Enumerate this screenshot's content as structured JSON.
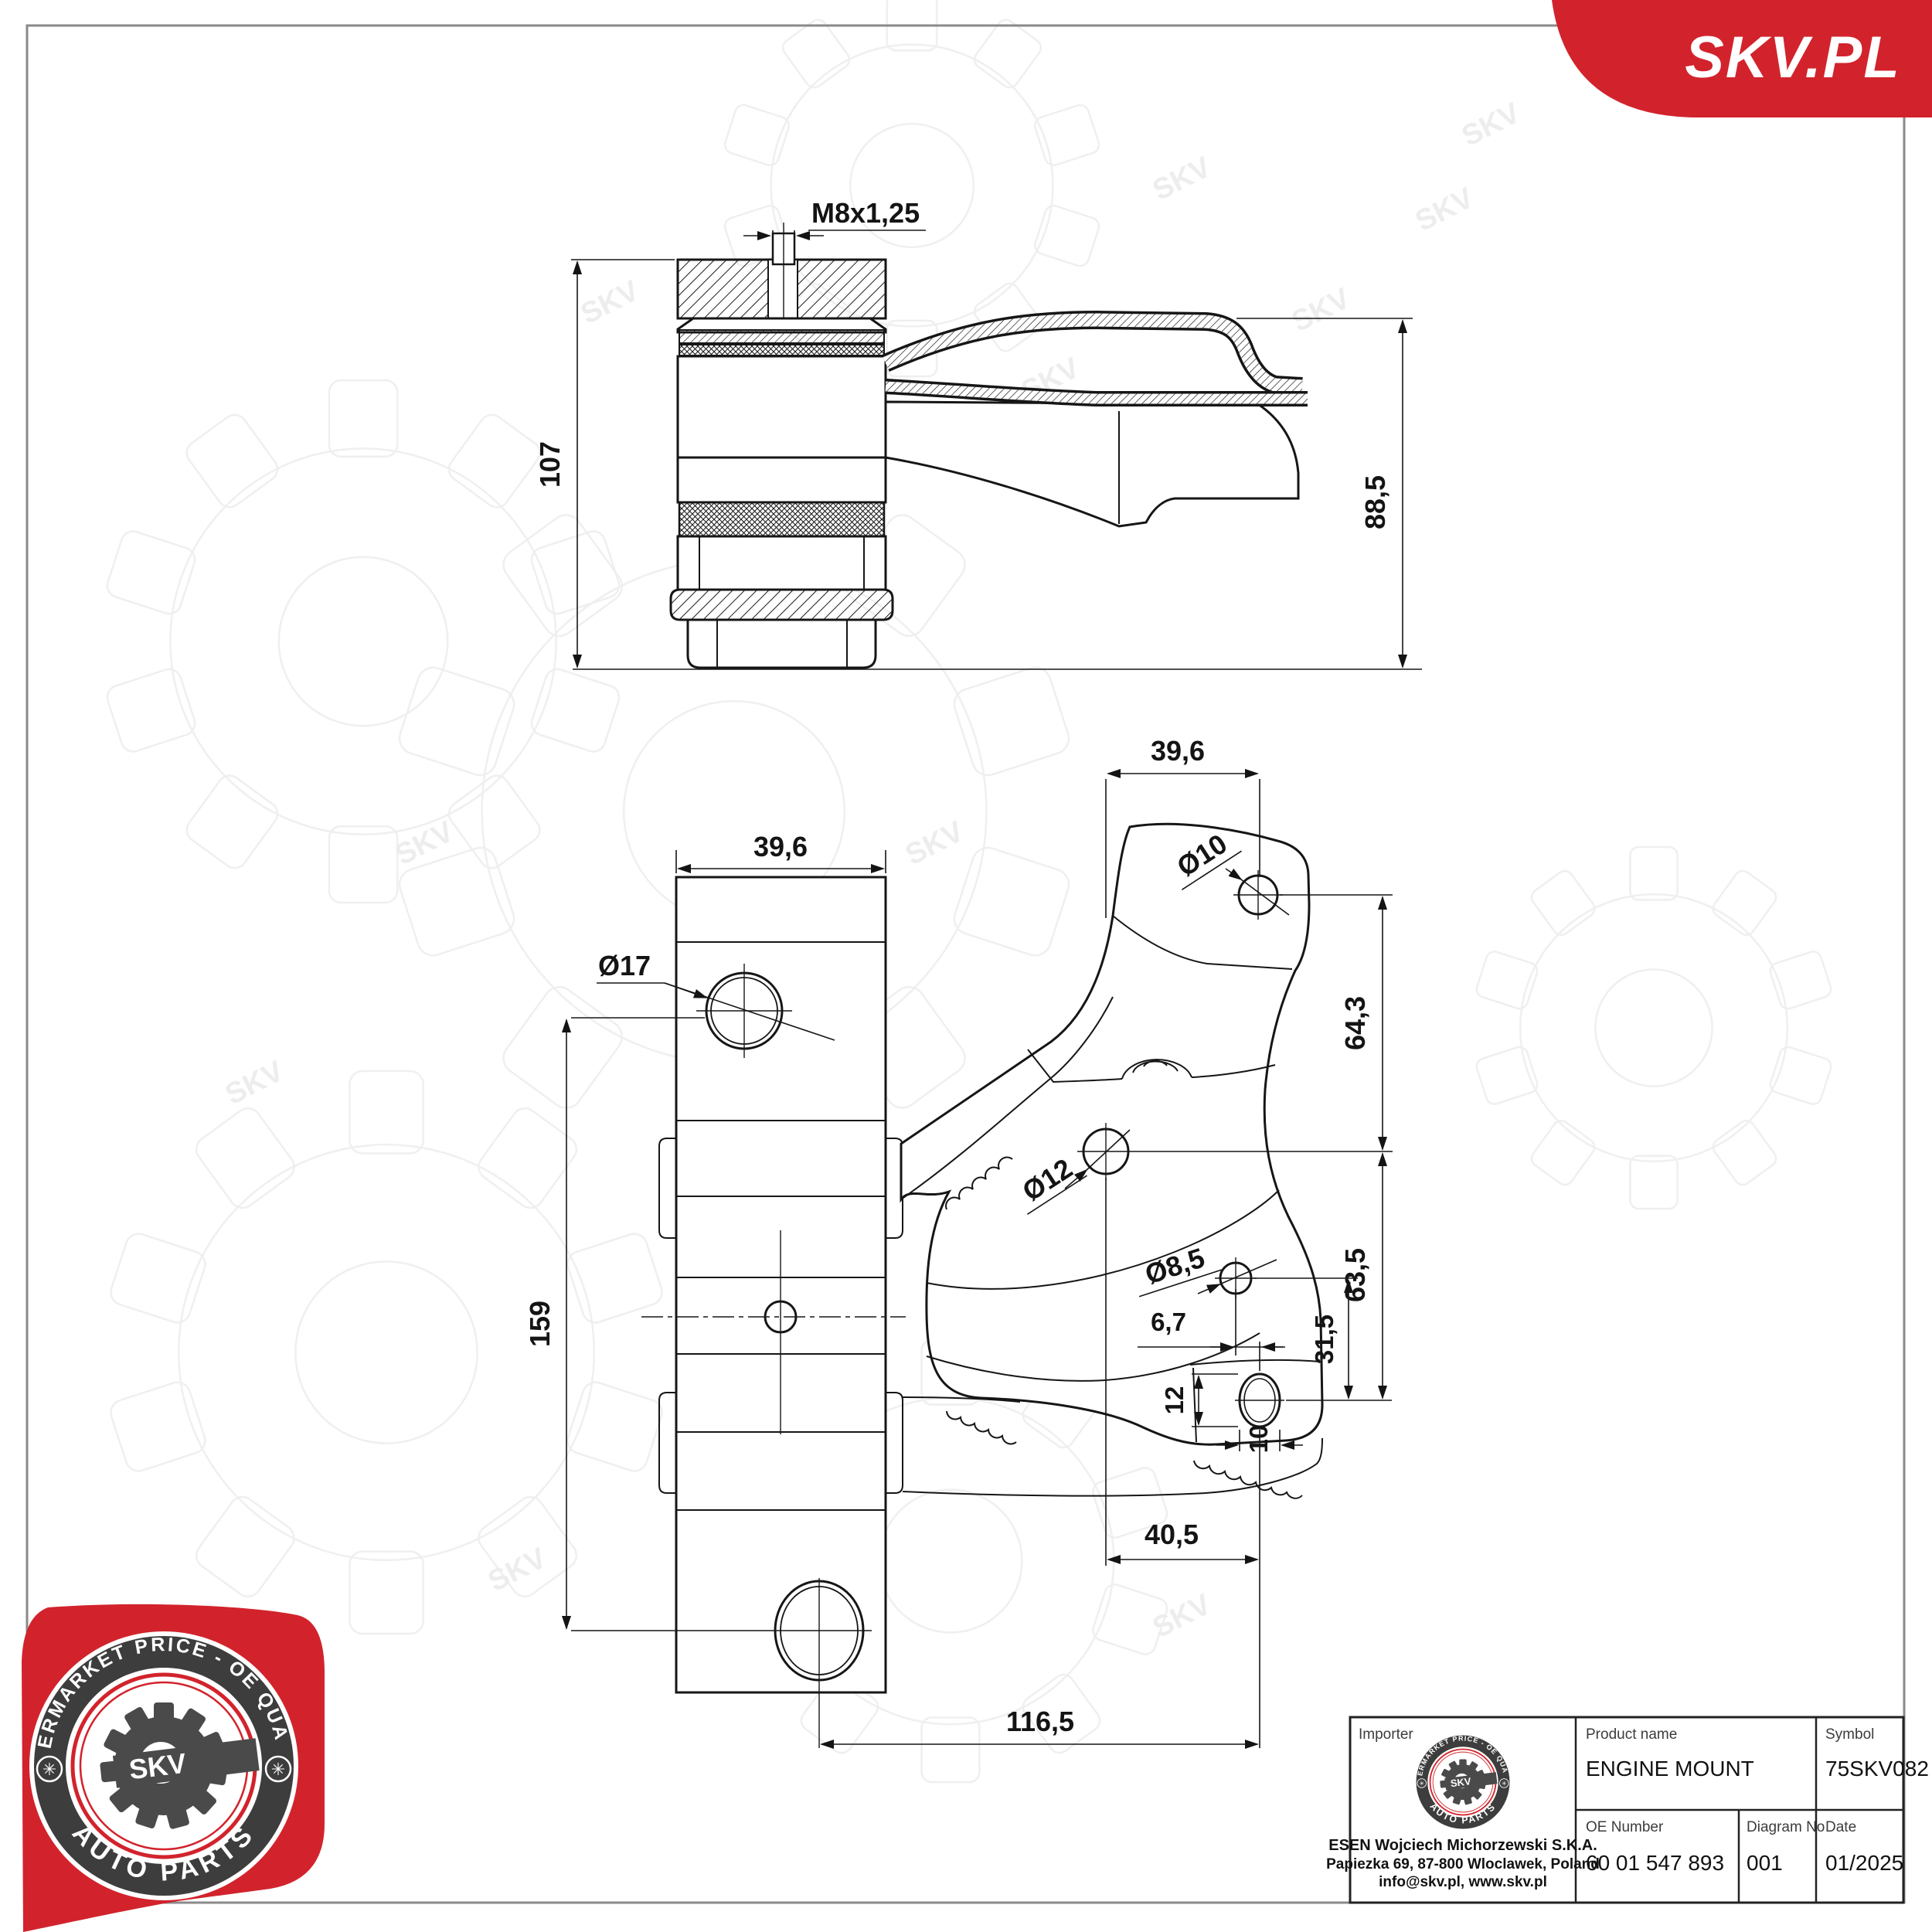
{
  "page": {
    "background": "#ffffff",
    "frame_color": "#8a8a8a",
    "line_color": "#161616",
    "accent_red": "#d2232c",
    "watermark_text": "SKV"
  },
  "banner": {
    "label": "SKV.PL"
  },
  "views": {
    "section": {
      "thread": "M8x1,25",
      "total_height": "107",
      "arm_height": "88,5"
    },
    "front": {
      "width": "39,6",
      "top_hole": "Ø17",
      "height": "159",
      "hole_span": "116,5"
    },
    "bracket": {
      "width": "39,6",
      "top_hole": "Ø10",
      "top_offset": "64,3",
      "mid_hole": "Ø12",
      "low_hole": "Ø8,5",
      "low_offset_x": "6,7",
      "mid_to_slot": "63,5",
      "low_to_slot": "31,5",
      "slot_h": "12",
      "slot_w": "10",
      "slot_offset_x": "40,5"
    }
  },
  "badge": {
    "arc_top": "AFTERMARKET PRICE - OE QUALITY",
    "arc_bottom": "AUTO PARTS",
    "monogram": "SKV",
    "side_mark": "✳"
  },
  "title_block": {
    "importer_label": "Importer",
    "importer_name": "ESEN Wojciech Michorzewski S.K.A.",
    "importer_address": "Papiezka 69, 87-800 Wloclawek, Poland",
    "importer_contact": "info@skv.pl, www.skv.pl",
    "product_label": "Product name",
    "product_value": "ENGINE MOUNT",
    "symbol_label": "Symbol",
    "symbol_value": "75SKV082",
    "oe_label": "OE Number",
    "oe_value": "60 01 547 893",
    "diagram_label": "Diagram No",
    "diagram_value": "001",
    "date_label": "Date",
    "date_value": "01/2025"
  }
}
